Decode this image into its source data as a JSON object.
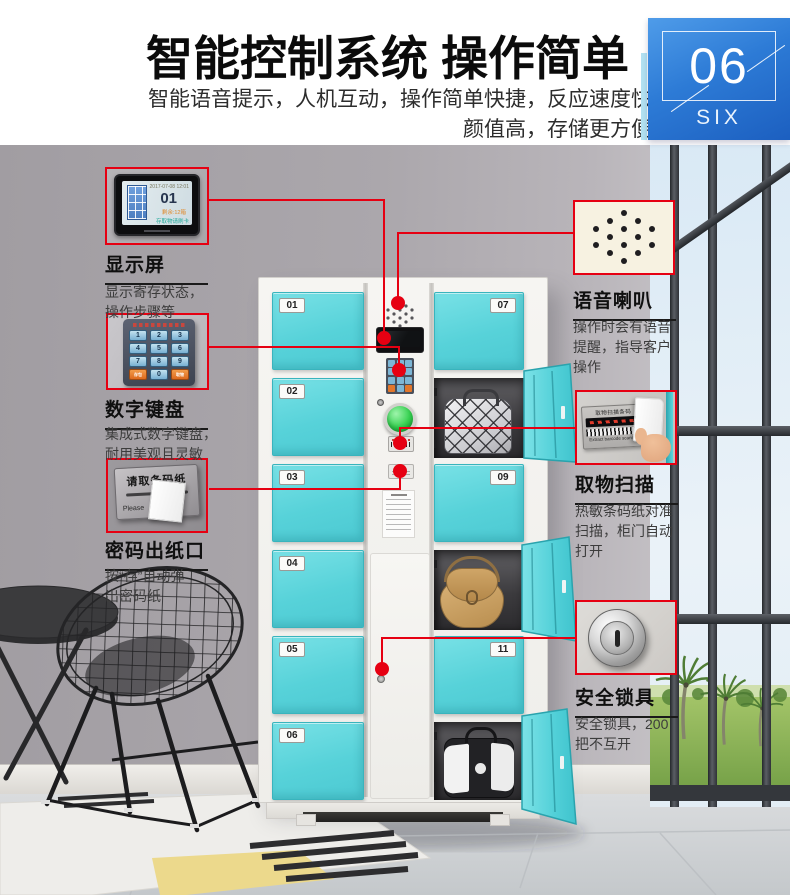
{
  "header": {
    "title": "智能控制系统 操作简单",
    "subtitle_line1": "智能语音提示，人机互动，操作简单快捷，反应速度快",
    "subtitle_line2": "颜值高，存储更方便"
  },
  "badge": {
    "number": "06",
    "word": "SIX"
  },
  "callouts": {
    "display": {
      "title": "显示屏",
      "desc1": "显示寄存状态，",
      "desc2": "操作步骤等"
    },
    "keypad": {
      "title": "数字键盘",
      "desc1": "集成式数字键盘，",
      "desc2": "耐用美观且灵敏"
    },
    "paper": {
      "title": "密码出纸口",
      "desc1": "按“存”自动弹",
      "desc2": "出密码纸"
    },
    "speaker": {
      "title": "语音喇叭",
      "desc1": "操作时会有语音",
      "desc2": "提醒，指导客户",
      "desc3": "操作"
    },
    "scan": {
      "title": "取物扫描",
      "desc1": "热敏条码纸对准",
      "desc2": "扫描，柜门自动",
      "desc3": "打开"
    },
    "lock": {
      "title": "安全锁具",
      "desc1": "安全锁具，200",
      "desc2": "把不互开"
    }
  },
  "locker": {
    "left_doors": [
      "01",
      "02",
      "03",
      "04",
      "05",
      "06"
    ],
    "right_doors": [
      "07",
      "09",
      "11"
    ],
    "screen": {
      "datetime": "2017-07-08 12:01",
      "big_number": "01",
      "status_line1": "剩余:12箱",
      "status_line2": "存取物请刷卡"
    },
    "keypad_keys": [
      "1",
      "2",
      "3",
      "4",
      "5",
      "6",
      "7",
      "8",
      "9"
    ],
    "keypad_store": "存包",
    "keypad_zero": "0",
    "keypad_take": "取物",
    "paper_plate_text": "请取条码纸",
    "paper_plate_subtext": "Please",
    "scan_plate_text": "取物扫描条码",
    "scan_plate_subtext": "Extract barcode scanning"
  },
  "colors": {
    "accent_red": "#e60012",
    "door_cyan": "#5ed8de",
    "badge_blue": "#2b79d4"
  }
}
